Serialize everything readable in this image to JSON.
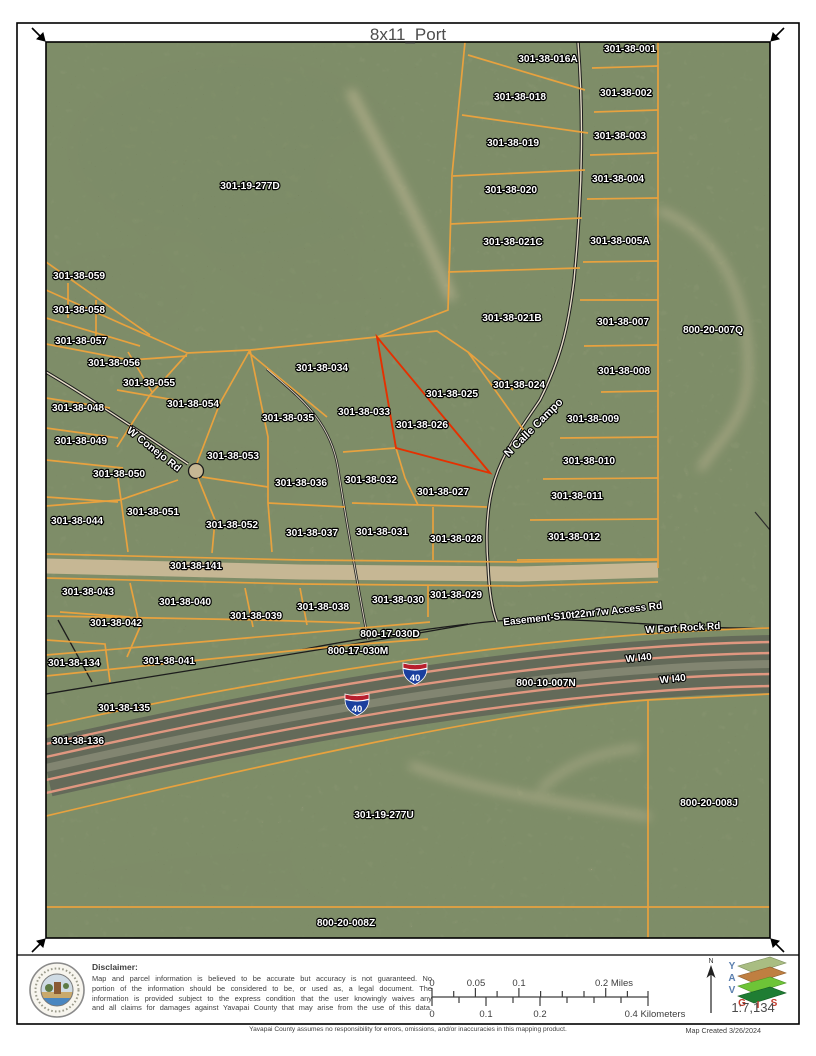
{
  "page": {
    "title": "8x11_Port"
  },
  "map": {
    "highlighted_parcel": "301-38-026",
    "colors": {
      "parcel_line": "#eda33c",
      "highlight": "#e53000",
      "label_fill": "#ffffff",
      "shield_red": "#b81f2d",
      "shield_blue": "#1b3f9e",
      "freeway_edge": "#e09780"
    },
    "parcels": [
      {
        "label": "301-38-016A",
        "x": 548,
        "y": 62
      },
      {
        "label": "301-38-001",
        "x": 630,
        "y": 52
      },
      {
        "label": "301-38-018",
        "x": 520,
        "y": 100
      },
      {
        "label": "301-38-002",
        "x": 626,
        "y": 96
      },
      {
        "label": "301-38-019",
        "x": 513,
        "y": 146
      },
      {
        "label": "301-38-003",
        "x": 620,
        "y": 139
      },
      {
        "label": "301-38-020",
        "x": 511,
        "y": 193
      },
      {
        "label": "301-38-004",
        "x": 618,
        "y": 182
      },
      {
        "label": "301-38-021C",
        "x": 513,
        "y": 245
      },
      {
        "label": "301-38-005A",
        "x": 620,
        "y": 244
      },
      {
        "label": "301-19-277D",
        "x": 250,
        "y": 189
      },
      {
        "label": "301-38-059",
        "x": 79,
        "y": 279
      },
      {
        "label": "301-38-058",
        "x": 79,
        "y": 313
      },
      {
        "label": "301-38-057",
        "x": 81,
        "y": 344
      },
      {
        "label": "301-38-056",
        "x": 114,
        "y": 366
      },
      {
        "label": "301-38-055",
        "x": 149,
        "y": 386
      },
      {
        "label": "301-38-054",
        "x": 193,
        "y": 407
      },
      {
        "label": "301-38-048",
        "x": 78,
        "y": 411
      },
      {
        "label": "301-38-049",
        "x": 81,
        "y": 444
      },
      {
        "label": "301-38-021B",
        "x": 512,
        "y": 321
      },
      {
        "label": "800-20-007Q",
        "x": 713,
        "y": 333
      },
      {
        "label": "301-38-007",
        "x": 623,
        "y": 325
      },
      {
        "label": "301-38-008",
        "x": 624,
        "y": 374
      },
      {
        "label": "301-38-024",
        "x": 519,
        "y": 388
      },
      {
        "label": "301-38-025",
        "x": 452,
        "y": 397
      },
      {
        "label": "301-38-034",
        "x": 322,
        "y": 371
      },
      {
        "label": "301-38-033",
        "x": 364,
        "y": 415
      },
      {
        "label": "301-38-035",
        "x": 288,
        "y": 421
      },
      {
        "label": "301-38-026",
        "x": 422,
        "y": 428
      },
      {
        "label": "301-38-009",
        "x": 593,
        "y": 422
      },
      {
        "label": "301-38-010",
        "x": 589,
        "y": 464
      },
      {
        "label": "301-38-053",
        "x": 233,
        "y": 459
      },
      {
        "label": "301-38-050",
        "x": 119,
        "y": 477
      },
      {
        "label": "301-38-036",
        "x": 301,
        "y": 486
      },
      {
        "label": "301-38-032",
        "x": 371,
        "y": 483
      },
      {
        "label": "301-38-027",
        "x": 443,
        "y": 495
      },
      {
        "label": "301-38-011",
        "x": 577,
        "y": 499
      },
      {
        "label": "301-38-051",
        "x": 153,
        "y": 515
      },
      {
        "label": "301-38-044",
        "x": 77,
        "y": 524
      },
      {
        "label": "301-38-052",
        "x": 232,
        "y": 528
      },
      {
        "label": "301-38-037",
        "x": 312,
        "y": 536
      },
      {
        "label": "301-38-031",
        "x": 382,
        "y": 535
      },
      {
        "label": "301-38-028",
        "x": 456,
        "y": 542
      },
      {
        "label": "301-38-012",
        "x": 574,
        "y": 540
      },
      {
        "label": "301-38-141",
        "x": 196,
        "y": 569
      },
      {
        "label": "301-38-043",
        "x": 88,
        "y": 595
      },
      {
        "label": "301-38-040",
        "x": 185,
        "y": 605
      },
      {
        "label": "301-38-039",
        "x": 256,
        "y": 619
      },
      {
        "label": "301-38-038",
        "x": 323,
        "y": 610
      },
      {
        "label": "301-38-030",
        "x": 398,
        "y": 603
      },
      {
        "label": "301-38-029",
        "x": 456,
        "y": 598
      },
      {
        "label": "301-38-042",
        "x": 116,
        "y": 626
      },
      {
        "label": "800-17-030D",
        "x": 390,
        "y": 637
      },
      {
        "label": "800-17-030M",
        "x": 358,
        "y": 654
      },
      {
        "label": "301-38-134",
        "x": 74,
        "y": 666
      },
      {
        "label": "301-38-041",
        "x": 169,
        "y": 664
      },
      {
        "label": "800-10-007N",
        "x": 546,
        "y": 686
      },
      {
        "label": "301-38-135",
        "x": 124,
        "y": 711
      },
      {
        "label": "301-38-136",
        "x": 78,
        "y": 744
      },
      {
        "label": "301-19-277U",
        "x": 384,
        "y": 818
      },
      {
        "label": "800-20-008J",
        "x": 709,
        "y": 806
      },
      {
        "label": "800-20-008Z",
        "x": 346,
        "y": 926
      }
    ],
    "roads": [
      {
        "label": "W Conejo Rd",
        "x": 152,
        "y": 452,
        "rot": 38,
        "size": 10.5
      },
      {
        "label": "N Calle Campo",
        "x": 536,
        "y": 430,
        "rot": -45,
        "size": 11
      },
      {
        "label": "Easement-S10t22nr7w Access Rd",
        "x": 583,
        "y": 617,
        "rot": -6,
        "size": 10
      },
      {
        "label": "W Fort Rock Rd",
        "x": 683,
        "y": 631,
        "rot": -3,
        "size": 10
      },
      {
        "label": "W I40",
        "x": 639,
        "y": 661,
        "rot": -6,
        "size": 10
      },
      {
        "label": "W I40",
        "x": 673,
        "y": 682,
        "rot": -6,
        "size": 10
      }
    ],
    "shields": [
      {
        "label": "40",
        "x": 415,
        "y": 673
      },
      {
        "label": "40",
        "x": 357,
        "y": 704
      }
    ]
  },
  "footer": {
    "disclaimer_title": "Disclaimer:",
    "disclaimer_lines": [
      "Map and parcel information is believed to be accurate but accuracy is not guaranteed. No",
      "portion of the information should be considered to be, or used as, a legal document. The",
      "information is provided subject to the express condition that the user knowingly waives any",
      "and all claims for damages against Yavapai County that may arise from the use of this data."
    ],
    "scale_miles": [
      {
        "label": "0",
        "x": 432
      },
      {
        "label": "0.05",
        "x": 476
      },
      {
        "label": "0.1",
        "x": 519
      },
      {
        "label": "0.2 Miles",
        "x": 614
      }
    ],
    "scale_km": [
      {
        "label": "0",
        "x": 432
      },
      {
        "label": "0.1",
        "x": 486
      },
      {
        "label": "0.2",
        "x": 540
      },
      {
        "label": "0.4 Kilometers",
        "x": 655
      }
    ],
    "scale_ratio": "1:7,134",
    "north_label": "N",
    "logo_letters": [
      "Y",
      "A",
      "V",
      "G",
      "I",
      "S"
    ]
  },
  "bottom": {
    "left_note": "Yavapai County assumes no responsibility for errors, omissions, and/or inaccuracies in this mapping product.",
    "right_note": "Map Created 3/26/2024"
  }
}
